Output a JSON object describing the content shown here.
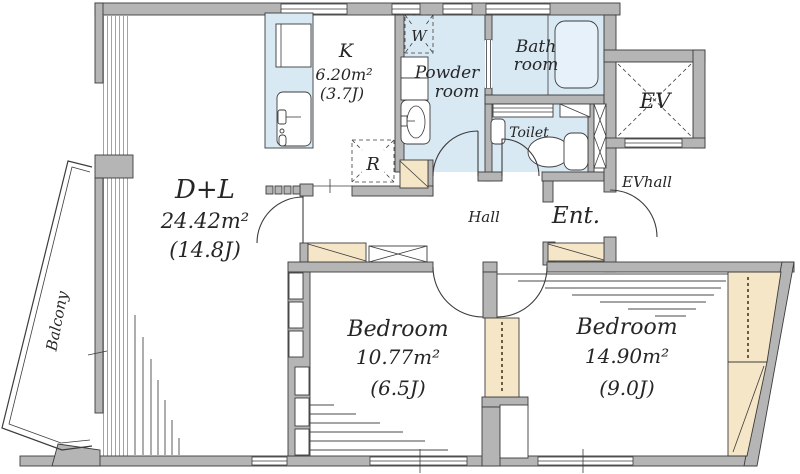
{
  "floorplan": {
    "rooms": {
      "living": {
        "name": "D+L",
        "area": "24.42m²",
        "tatami": "(14.8J)"
      },
      "kitchen": {
        "name": "K",
        "area": "6.20m²",
        "tatami": "(3.7J)"
      },
      "powder": {
        "line1": "Powder",
        "line2": "room"
      },
      "bath": {
        "line1": "Bath",
        "line2": "room"
      },
      "toilet": {
        "name": "Toilet"
      },
      "bedroom1": {
        "name": "Bedroom",
        "area": "10.77m²",
        "tatami": "(6.5J)"
      },
      "bedroom2": {
        "name": "Bedroom",
        "area": "14.90m²",
        "tatami": "(9.0J)"
      },
      "entrance": {
        "name": "Ent."
      },
      "hall": {
        "name": "Hall"
      },
      "ev_hall": {
        "name": "EVhall"
      },
      "elevator": {
        "name": "EV"
      },
      "balcony": {
        "name": "Balcony"
      }
    },
    "fixtures": {
      "washer": {
        "label": "W"
      },
      "refrigerator": {
        "label": "R"
      }
    },
    "colors": {
      "wall_fill": "#b5b5b5",
      "wet_room_fill": "#d9e9f4",
      "closet_fill": "#f6e6c8",
      "outline": "#3c3c3c"
    }
  }
}
